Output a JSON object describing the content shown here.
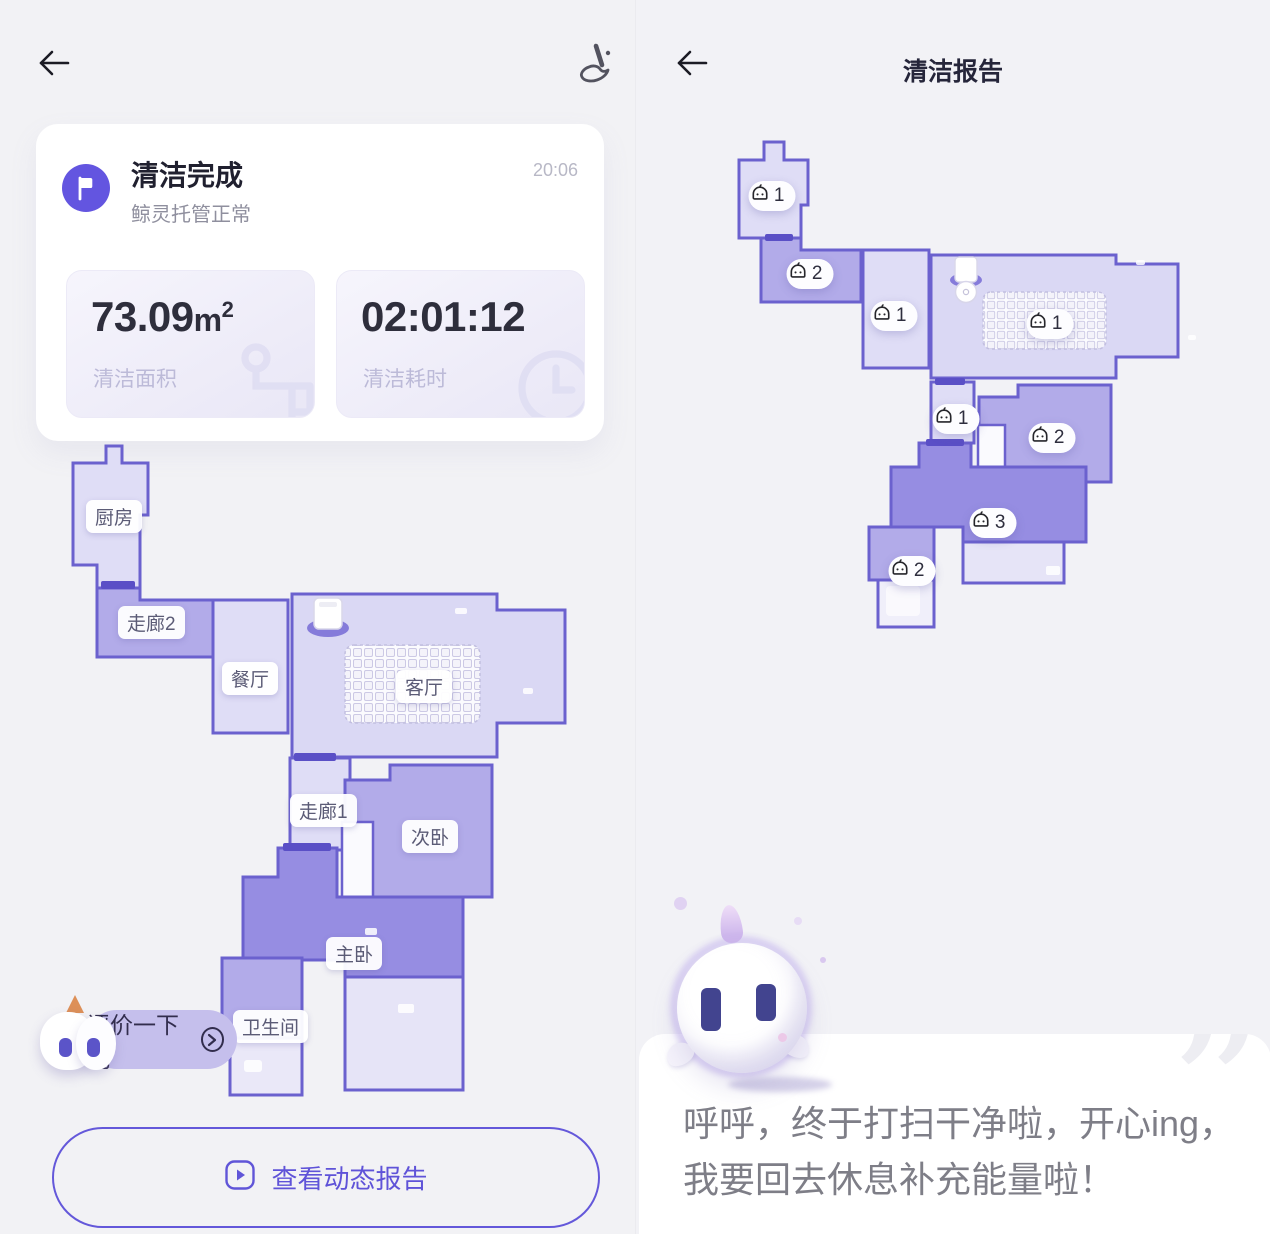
{
  "colors": {
    "accent": "#6054d8",
    "wall": "#6b61ce",
    "room_light": "#dfddf6",
    "room_medium": "#b2abe9",
    "room_dark": "#968de2",
    "flag_badge": "#6355e0",
    "bubble_bg": "#c5bfec"
  },
  "left": {
    "icons": {
      "back": "back-arrow",
      "broom": "broom"
    },
    "card": {
      "title": "清洁完成",
      "subtitle": "鲸灵托管正常",
      "time": "20:06",
      "area": {
        "value": "73.09",
        "unit": "m",
        "sup": "2",
        "label": "清洁面积"
      },
      "duration": {
        "value": "02:01:12",
        "label": "清洁耗时"
      }
    },
    "rooms": [
      {
        "label": "厨房"
      },
      {
        "label": "走廊2"
      },
      {
        "label": "餐厅"
      },
      {
        "label": "客厅"
      },
      {
        "label": "走廊1"
      },
      {
        "label": "次卧"
      },
      {
        "label": "主卧"
      },
      {
        "label": "卫生间"
      }
    ],
    "bubble": {
      "text": "评价一下吧"
    },
    "report_button": {
      "label": "查看动态报告"
    }
  },
  "right": {
    "icons": {
      "back": "back-arrow"
    },
    "title": "清洁报告",
    "badges": [
      {
        "count": "× 1"
      },
      {
        "count": "× 2"
      },
      {
        "count": "× 1"
      },
      {
        "count": "× 1"
      },
      {
        "count": "× 1"
      },
      {
        "count": "× 2"
      },
      {
        "count": "× 3"
      },
      {
        "count": "× 2"
      }
    ],
    "quote": {
      "text": "呼呼，终于打扫干净啦，开心ing，我要回去休息补充能量啦！",
      "mark": "”"
    }
  }
}
